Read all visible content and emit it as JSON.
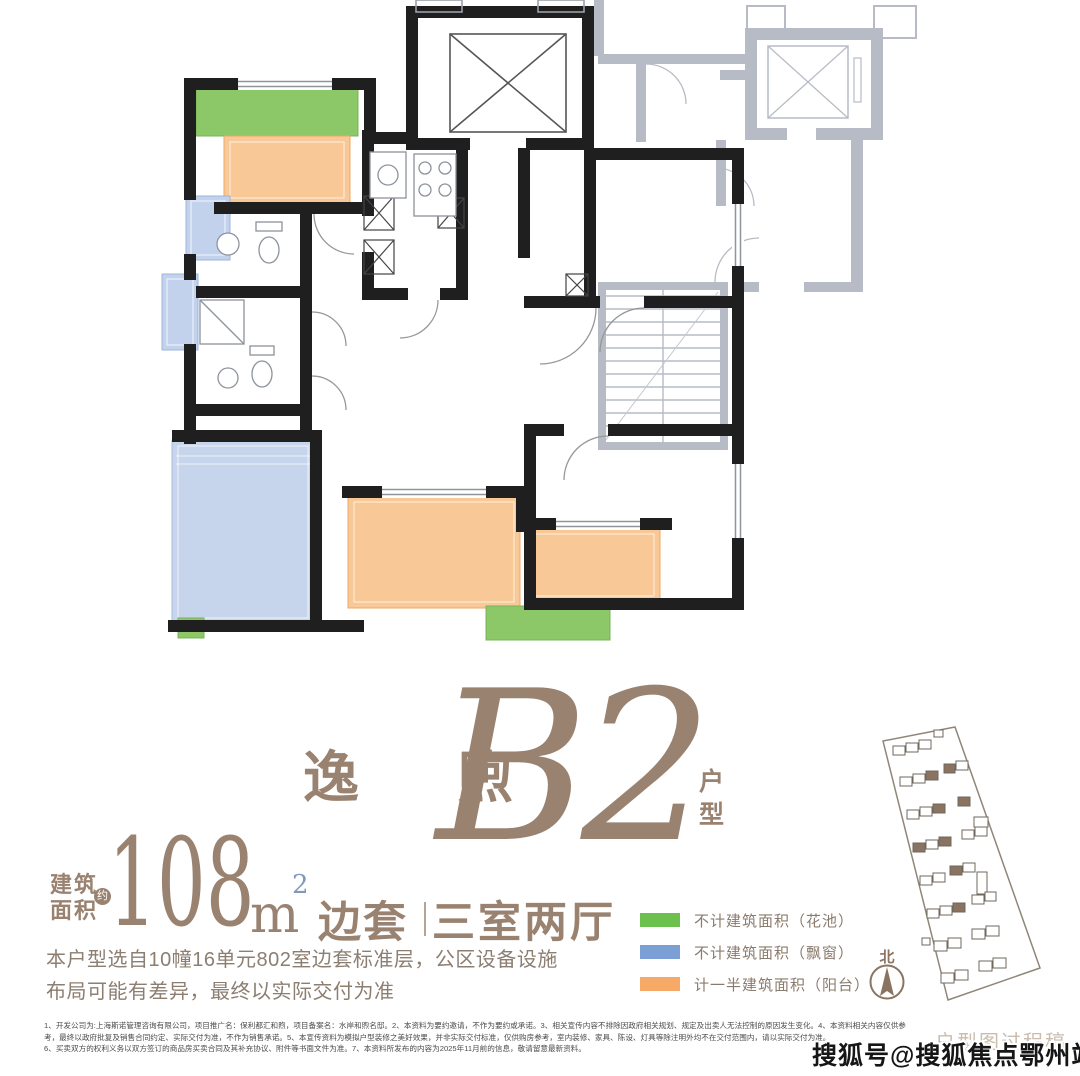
{
  "title": {
    "brand": "逸 煦",
    "code": "B2",
    "suffix": "户型"
  },
  "area": {
    "label_line1": "建筑",
    "label_line2": "面积",
    "approx_badge": "约",
    "value": "108",
    "unit": "m",
    "unit_exp": "2",
    "tag": "边套",
    "divider": "｜",
    "rooms": "三室两厅"
  },
  "description": {
    "line1": "本户型选自10幢16单元802室边套标准层，公区设备设施",
    "line2": "布局可能有差异，最终以实际交付为准"
  },
  "legend": {
    "items": [
      {
        "label": "不计建筑面积（花池）",
        "color": "#6cc04e"
      },
      {
        "label": "不计建筑面积（飘窗）",
        "color": "#7c9fd6"
      },
      {
        "label": "计一半建筑面积（阳台）",
        "color": "#f7a968"
      }
    ]
  },
  "compass": {
    "north_label": "北"
  },
  "site_plan": {
    "process_note": "户型图过程稿"
  },
  "watermark": {
    "text": "搜狐号@搜狐焦点鄂州站"
  },
  "disclaimer": {
    "line1": "1、开发公司为:上海斯诺管理咨询有限公司，项目推广名：保利都汇和煦，项目备案名：水岸和煦名邸。2、本资料为要约邀请，不作为要约或承诺。3、相关宣传内容不排除因政府相关规划、规定及出卖人无法控制的原因发生变化。4、本资料相关内容仅供参",
    "line2": "考，最终以政府批复及销售合同约定、实际交付为准，不作为销售承诺。5、本宣传资料为模拟户型装修之美好效果，并非实际交付标准，仅供购房参考，室内装修、家具、陈设、灯具等除注明外均不在交付范围内，请以实际交付为准。",
    "line3": "6、买卖双方的权利义务以双方签订的商品房买卖合同及其补充协议、附件等书面文件为准。7、本资料所发布的内容为2025年11月前的信息，敬请留意最新资料。"
  },
  "colors": {
    "brand_brown": "#9a8270",
    "plan_green": "#8cc868",
    "plan_blue": "#c3d2ec",
    "plan_orange": "#f9c897",
    "legend_green": "#6cc04e",
    "legend_blue": "#7c9fd6",
    "legend_orange": "#f7a968",
    "gray_unit": "#b6bbc5",
    "wall": "#1f1f1f",
    "site_building": "#8a7361"
  }
}
